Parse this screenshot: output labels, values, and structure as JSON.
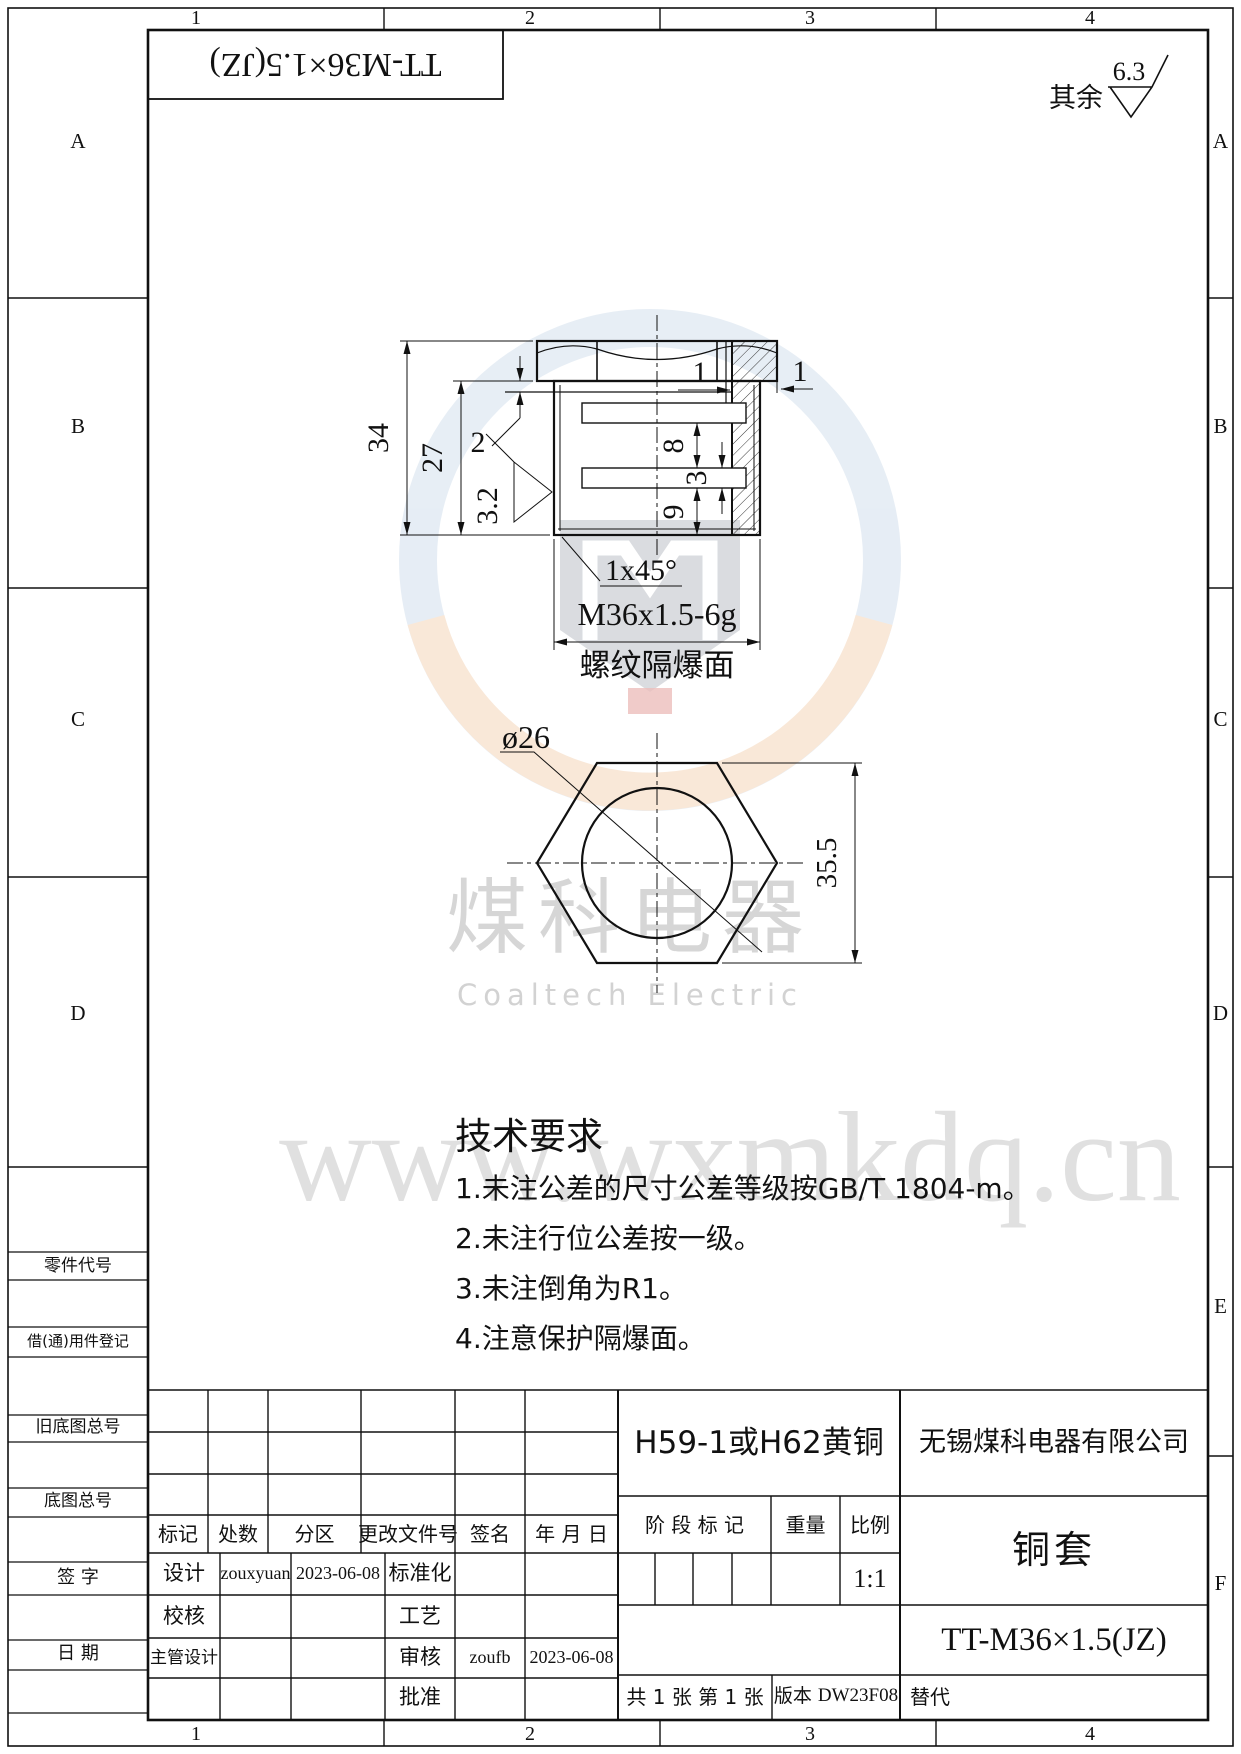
{
  "frame": {
    "zones_top": [
      "1",
      "2",
      "3",
      "4"
    ],
    "zones_bottom": [
      "1",
      "2",
      "3",
      "4"
    ],
    "zones_left": [
      "A",
      "B",
      "C",
      "D"
    ],
    "zones_right": [
      "A",
      "B",
      "C",
      "D",
      "E",
      "F"
    ],
    "part_no_box": "TT-M36×1.5(JZ)",
    "surplus_label": "其余",
    "surplus_roughness": "6.3"
  },
  "margin_labels": [
    "零件代号",
    "借(通)用件登记",
    "旧底图总号",
    "底图总号",
    "签 字",
    "日 期"
  ],
  "views": {
    "section": {
      "d34": "34",
      "d27": "27",
      "d2": "2",
      "rough": "3.2",
      "d1_top": "1",
      "d1_side": "1",
      "d8": "8",
      "d3": "3",
      "d9": "9",
      "chamfer": "1x45°",
      "thread": "M36x1.5-6g",
      "thread_note": "螺纹隔爆面"
    },
    "hex": {
      "bore": "ø26",
      "across_flats": "35.5"
    }
  },
  "tech": {
    "title": "技术要求",
    "items": [
      "1.未注公差的尺寸公差等级按GB/T 1804-m。",
      "2.未注行位公差按一级。",
      "3.未注倒角为R1。",
      "4.注意保护隔爆面。"
    ]
  },
  "watermark": {
    "cn": "煤科电器",
    "en": "Coaltech Electric",
    "url": "www.wxmkdq.cn"
  },
  "title_block": {
    "rev_header": [
      "标记",
      "处数",
      "分区",
      "更改文件号",
      "签名",
      "年 月 日"
    ],
    "rows": {
      "design_label": "设计",
      "design_name": "zouxyuan",
      "design_date": "2023-06-08",
      "std_label": "标准化",
      "check_label": "校核",
      "process_label": "工艺",
      "chief_label": "主管设计",
      "audit_label": "审核",
      "audit_name": "zoufb",
      "audit_date": "2023-06-08",
      "approve_label": "批准"
    },
    "material": "H59-1或H62黄铜",
    "company": "无锡煤科电器有限公司",
    "stage_label": "阶 段 标 记",
    "weight_label": "重量",
    "scale_label": "比例",
    "scale_value": "1:1",
    "part_name": "铜套",
    "drawing_no": "TT-M36×1.5(JZ)",
    "sheet_info": "共 1 张  第 1 张",
    "version_label": "版本",
    "version_value": "DW23F08",
    "replace_label": "替代"
  }
}
